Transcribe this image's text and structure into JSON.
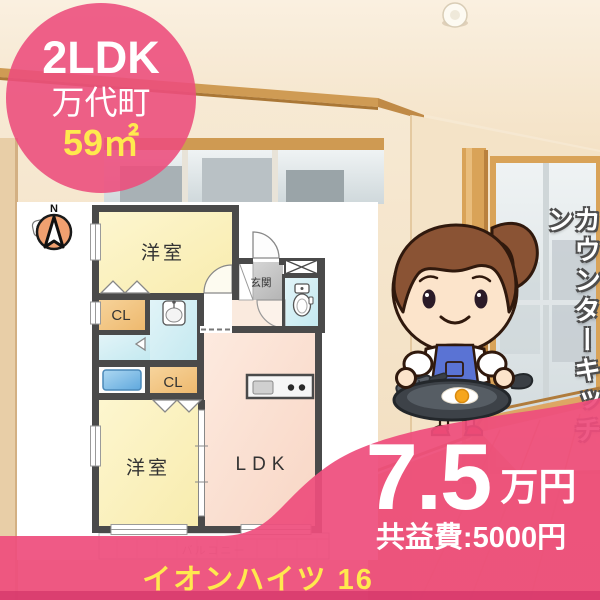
{
  "badge": {
    "layout": "2LDK",
    "town": "万代町",
    "area": "59㎡"
  },
  "compass": {
    "north": "N"
  },
  "floor_plan": {
    "room1": "洋室",
    "room2": "洋室",
    "ldk": "LDK",
    "entrance": "玄関",
    "closet1": "CL",
    "closet2": "CL",
    "balcony": "バルコニー"
  },
  "feature": {
    "vertical_text": "カウンターキッチン"
  },
  "price": {
    "amount": "7.5",
    "unit": "万円",
    "common_fee": "共益費:5000円"
  },
  "building": {
    "name": "イオンハイツ 16"
  },
  "colors": {
    "accent_pink": "#ee4d7d",
    "bottom_bar_pink": "#cf2f66",
    "highlight_yellow": "#ffe94e",
    "plan_wall": "#4a4a4a",
    "room_yellow": "#fbf2c0",
    "room_pink": "#fce7db",
    "room_cyan": "#d9f0f6",
    "closet_orange": "#f2c484"
  }
}
